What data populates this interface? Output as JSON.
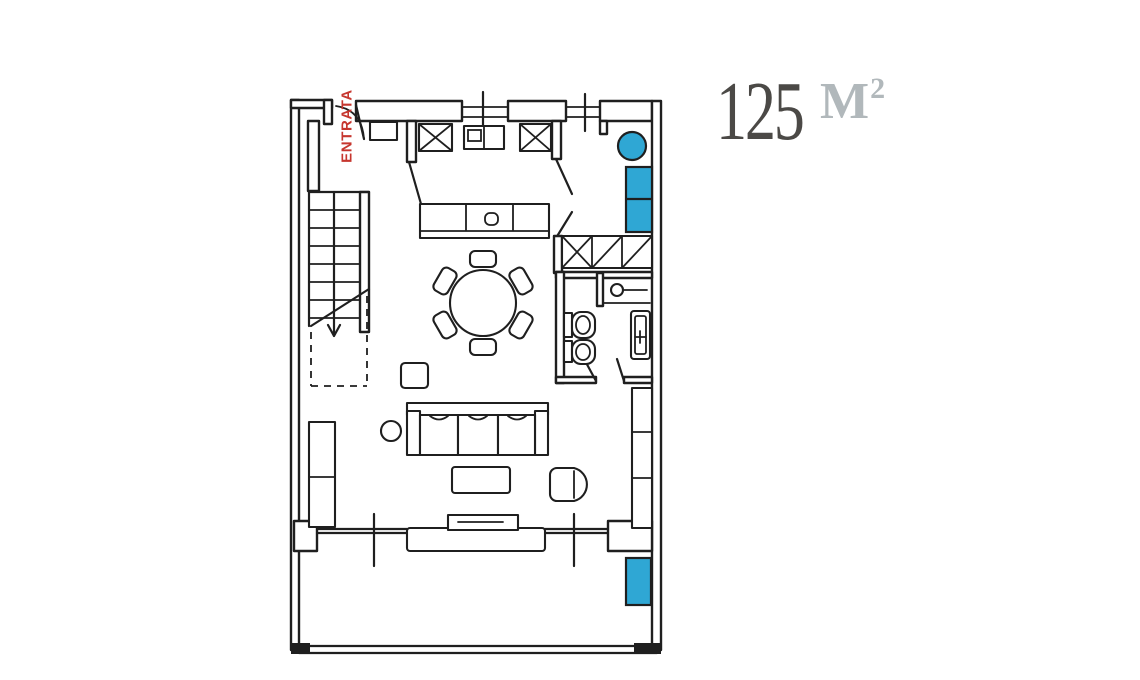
{
  "labels": {
    "entrance": "ENTRATA",
    "area_value": "125",
    "area_unit_base": "M",
    "area_unit_exp": "2"
  },
  "colors": {
    "line": "#1f1f1f",
    "accent_blue": "#2fa7d4",
    "entrance_red": "#c6362e",
    "area_value_color": "#4b4946",
    "area_unit_color": "#b1b8bb"
  },
  "plan": {
    "type": "floor-plan",
    "highlighted_items": [
      "round-seat",
      "bench-seat",
      "terrace-bench"
    ],
    "features": [
      "entrance-door",
      "staircase",
      "kitchen",
      "dining-table-with-6-chairs",
      "sofa",
      "coffee-table",
      "side-table",
      "armchair",
      "tv-sideboard",
      "wardrobe",
      "bathroom",
      "left-cabinet",
      "right-cabinet",
      "terrace"
    ]
  }
}
